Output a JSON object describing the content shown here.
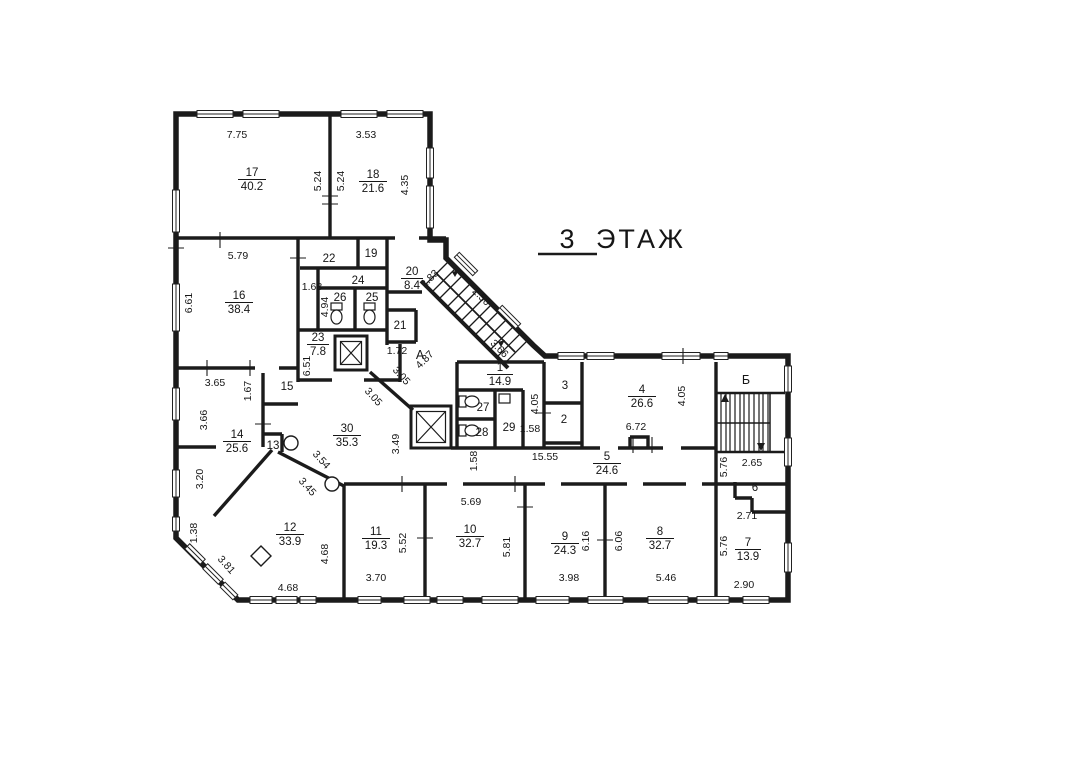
{
  "title": {
    "floor_number": "3",
    "floor_label": "ЭТАЖ"
  },
  "rooms": [
    {
      "number": "17",
      "area": "40.2"
    },
    {
      "number": "18",
      "area": "21.6"
    },
    {
      "number": "16",
      "area": "38.4"
    },
    {
      "number": "22",
      "area": ""
    },
    {
      "number": "19",
      "area": ""
    },
    {
      "number": "24",
      "area": ""
    },
    {
      "number": "26",
      "area": ""
    },
    {
      "number": "25",
      "area": ""
    },
    {
      "number": "20",
      "area": "8.4"
    },
    {
      "number": "21",
      "area": ""
    },
    {
      "number": "23",
      "area": "7.8"
    },
    {
      "number": "15",
      "area": ""
    },
    {
      "number": "14",
      "area": "25.6"
    },
    {
      "number": "13",
      "area": ""
    },
    {
      "number": "30",
      "area": "35.3"
    },
    {
      "number": "1",
      "area": "14.9"
    },
    {
      "number": "27",
      "area": ""
    },
    {
      "number": "28",
      "area": ""
    },
    {
      "number": "29",
      "area": ""
    },
    {
      "number": "3",
      "area": ""
    },
    {
      "number": "2",
      "area": ""
    },
    {
      "number": "4",
      "area": "26.6"
    },
    {
      "number": "5",
      "area": "24.6"
    },
    {
      "number": "6",
      "area": ""
    },
    {
      "number": "7",
      "area": "13.9"
    },
    {
      "number": "8",
      "area": "32.7"
    },
    {
      "number": "9",
      "area": "24.3"
    },
    {
      "number": "10",
      "area": "32.7"
    },
    {
      "number": "11",
      "area": "19.3"
    },
    {
      "number": "12",
      "area": "33.9"
    }
  ],
  "stairwells": [
    {
      "label": "А"
    },
    {
      "label": "Б"
    }
  ],
  "dims": [
    "7.75",
    "3.53",
    "5.24",
    "5.24",
    "4.35",
    "5.79",
    "6.61",
    "1.68",
    "4.94",
    "6.51",
    "3.65",
    "1.67",
    "3.66",
    "3.20",
    "1.38",
    "3.81",
    "4.68",
    "4.68",
    "3.70",
    "5.52",
    "5.69",
    "5.81",
    "3.98",
    "6.16",
    "6.06",
    "5.46",
    "2.90",
    "5.76",
    "2.71",
    "2.65",
    "5.76",
    "6.72",
    "4.05",
    "4.05",
    "15.55",
    "1.58",
    "1.58",
    "3.49",
    "3.54",
    "3.45",
    "3.05",
    "3.05",
    "1.72",
    "2.83",
    "2.50",
    "4.87",
    "3.66"
  ]
}
